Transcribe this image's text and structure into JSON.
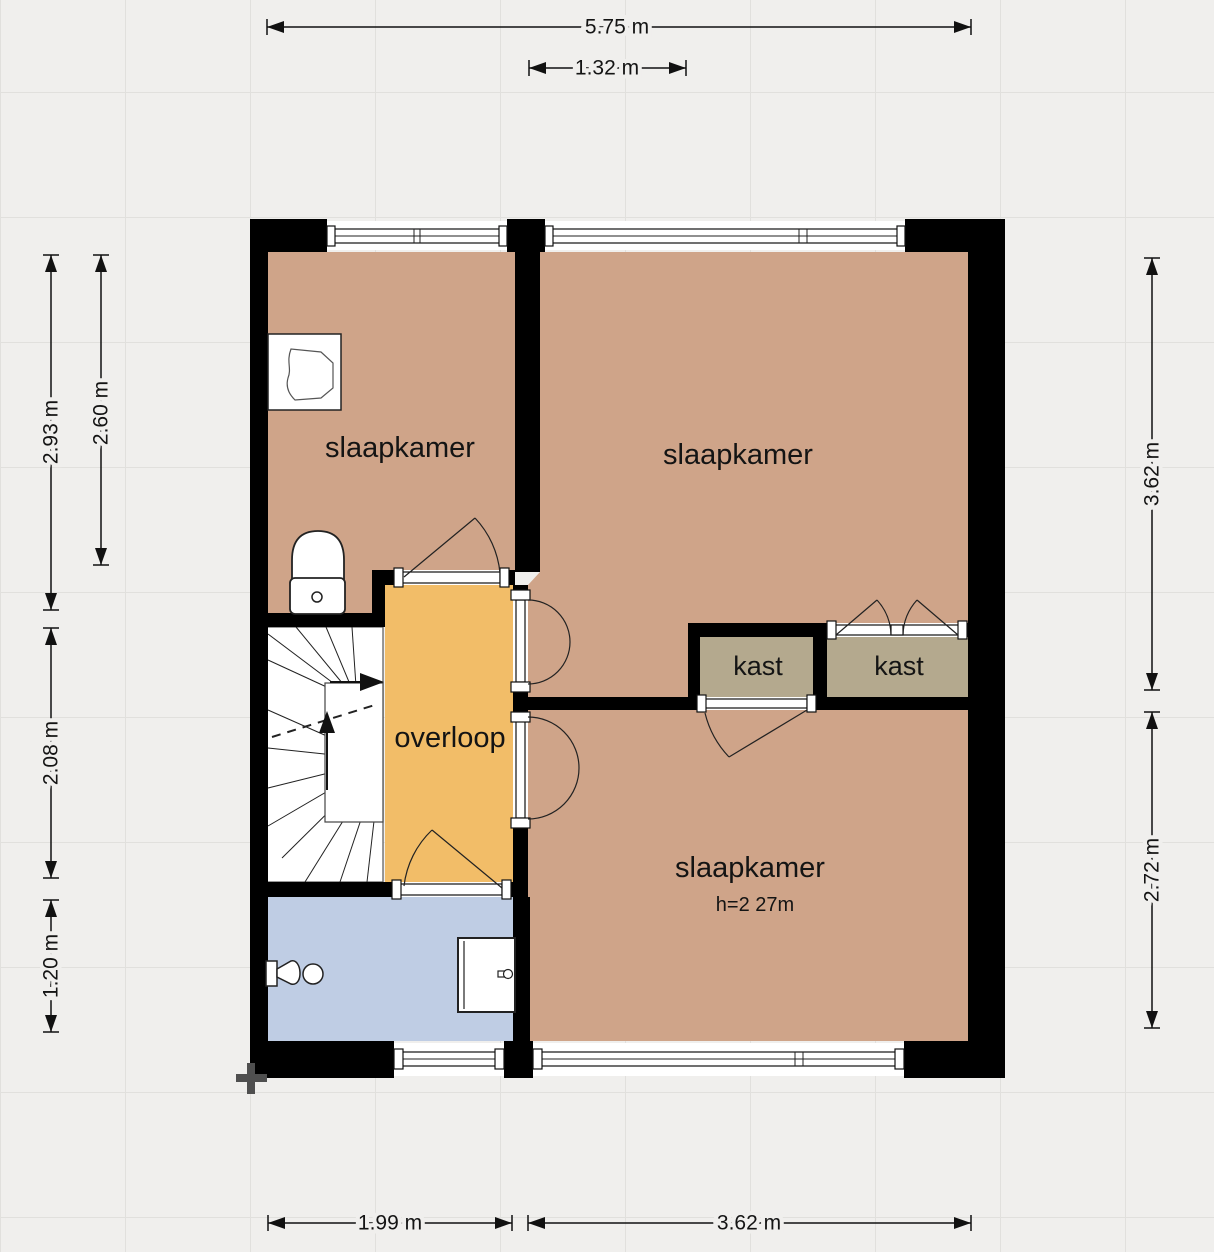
{
  "plan": {
    "rooms": {
      "bedroom_top_left": {
        "label": "slaapkamer"
      },
      "bedroom_top_right": {
        "label": "slaapkamer"
      },
      "bedroom_bottom": {
        "label": "slaapkamer",
        "height_note": "h=2 27m"
      },
      "landing": {
        "label": "overloop"
      },
      "closet_left": {
        "label": "kast"
      },
      "closet_right": {
        "label": "kast"
      }
    },
    "colors": {
      "wall": "#000000",
      "bedroom": "#cfa489",
      "closet": "#b4a98e",
      "landing": "#f2bd68",
      "bathroom": "#bfcde4",
      "stairs": "#ffffff",
      "background": "#f0efed",
      "grid_line": "#e1e0dd",
      "dimension_text": "#111111",
      "cross_marker": "#4f4f4f"
    },
    "dimensions": {
      "top_total": "5.75 m",
      "top_window": "1.32 m",
      "left_outer": "2.93 m",
      "left_inner": "2.60 m",
      "left_middle": "2.08 m",
      "left_lower": "1.20 m",
      "right_upper": "3.62 m",
      "right_lower": "2.72 m",
      "bottom_left": "1.99 m",
      "bottom_right": "3.62 m"
    }
  }
}
